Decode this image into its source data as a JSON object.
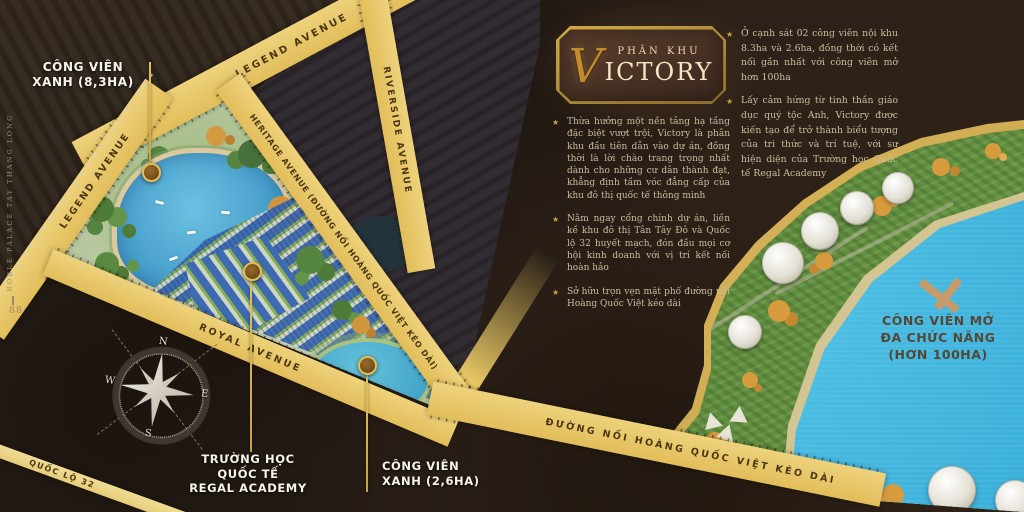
{
  "page": {
    "spine_text": "NOBLE PALACE TAY THANG LONG",
    "page_number": "88"
  },
  "title_box": {
    "subtitle": "PHÂN KHU",
    "initial": "V",
    "title_rest": "ICTORY"
  },
  "bullet_char": "★",
  "bullets_main": [
    "Thừa hưởng một nền tảng hạ tầng đặc biệt vượt trội, Victory là phân khu đầu tiên dẫn vào dự án, đồng thời là lời chào trang trọng nhất dành cho những cư dân thành đạt, khẳng định tầm vóc đẳng cấp của khu đô thị quốc tế thông minh",
    "Nằm ngay cổng chính dự án, liền kề khu đô thị Tân Tây Đô và Quốc lộ 32 huyết mạch, đón đầu mọi cơ hội kinh doanh với vị trí kết nối hoàn hảo",
    "Sở hữu trọn vẹn mặt phố đường nối Hoàng Quốc Việt kéo dài"
  ],
  "bullets_side": [
    "Ở cạnh sát 02 công viên nội khu 8.3ha và 2.6ha, đồng thời có kết nối gần nhất với công viên mở hơn 100ha",
    "Lấy cảm hứng từ tinh thần giáo dục quý tộc Anh, Victory được kiến tạo để trở thành biểu tượng của tri thức và trí tuệ, với sự hiện diện của Trường học Quốc tế Regal Academy"
  ],
  "map": {
    "roads": [
      {
        "id": "legend-avenue-top",
        "label": "LEGEND AVENUE"
      },
      {
        "id": "legend-avenue-left",
        "label": "LEGEND AVENUE"
      },
      {
        "id": "heritage-avenue",
        "label": "HERITAGE AVENUE (ĐƯỜNG NỐI HOÀNG QUỐC VIỆT KÉO DÀI)"
      },
      {
        "id": "riverside-avenue",
        "label": "RIVERSIDE AVENUE"
      },
      {
        "id": "royal-avenue",
        "label": "ROYAL AVENUE"
      },
      {
        "id": "quoc-lo-32",
        "label": "QUỐC LỘ 32"
      },
      {
        "id": "duong-noi-hoang-quoc-viet",
        "label": "ĐƯỜNG NỐI HOÀNG QUỐC VIỆT KÉO DÀI"
      }
    ],
    "callouts": [
      {
        "id": "green-park-8-3ha",
        "lines": [
          "CÔNG VIÊN",
          "XANH (8,3HA)"
        ]
      },
      {
        "id": "regal-academy-school",
        "lines": [
          "TRƯỜNG HỌC",
          "QUỐC TẾ",
          "REGAL ACADEMY"
        ]
      },
      {
        "id": "green-park-2-6ha",
        "lines": [
          "CÔNG VIÊN",
          "XANH (2,6HA)"
        ]
      },
      {
        "id": "open-park-100ha",
        "lines": [
          "CÔNG VIÊN MỞ",
          "ĐA CHỨC NĂNG",
          "(HƠN 100HA)"
        ]
      }
    ],
    "compass": {
      "north": "N",
      "east": "E",
      "south": "S",
      "west": "W"
    }
  },
  "colors": {
    "background": "#2a1f17",
    "gold_accent": "#c9a23c",
    "road_gold": "#e8c766",
    "lake_blue": "#3ab4e0",
    "roof_blue": "#3e6ab2",
    "park_green": "#5d8a3b",
    "body_text": "#cdbc9c",
    "label_white": "#f7f4ec"
  }
}
